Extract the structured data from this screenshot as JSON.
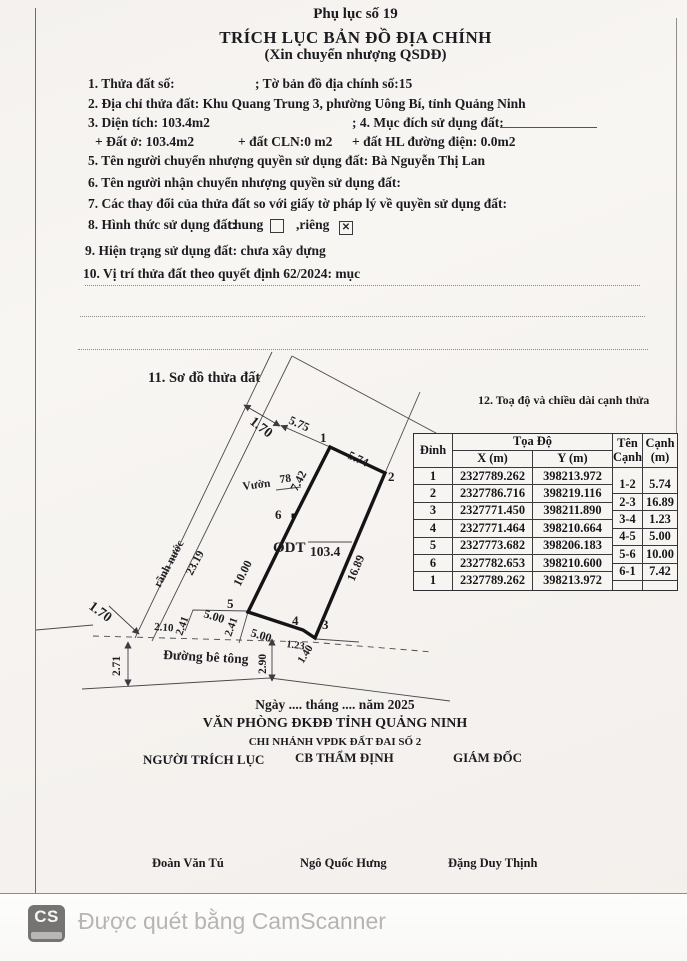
{
  "header": {
    "appendix": "Phụ lục số 19",
    "title": "TRÍCH LỤC BẢN ĐỒ ĐỊA CHÍNH",
    "subtitle": "(Xin chuyển nhượng QSDĐ)"
  },
  "fields": {
    "item1_label": "1. Thửa đất số:",
    "item1_value": "; Tờ bản đồ địa chính số:15",
    "item2": "2. Địa chỉ thửa đất: Khu Quang Trung 3, phường Uông Bí, tỉnh Quảng Ninh",
    "item3": "3. Diện tích: 103.4m2",
    "item4": "; 4. Mục đích sử dụng đất:",
    "item3_sub_a": "+ Đất ở: 103.4m2",
    "item3_sub_b": "+ đất CLN:0 m2",
    "item3_sub_c": "+ đất HL đường điện: 0.0m2",
    "item5": "5. Tên người chuyển nhượng quyền sử dụng đất: Bà Nguyễn Thị Lan",
    "item6": "6. Tên người nhận chuyển nhượng quyền sử dụng đất:",
    "item7": "7. Các thay đổi của thửa đất so với giấy tờ pháp lý về quyền sử dụng đất:",
    "item8_label": "8. Hình thức sử dụng đất:",
    "item8_chung": "chung",
    "item8_rieng": ",riêng",
    "item8_rieng_mark": "✕",
    "item9": "9. Hiện trạng sử dụng đất: chưa xây dựng",
    "item10": "10. Vị trí thửa đất theo quyết định 62/2024: mục"
  },
  "diagram": {
    "section_label": "11. Sơ đồ thửa đất",
    "area_label": "103.4",
    "land_use_code": "ODT",
    "labels": [
      {
        "t": "1.70",
        "x": 249,
        "y": 423,
        "r": 38,
        "s": 14
      },
      {
        "t": "5.75",
        "x": 288,
        "y": 423,
        "r": 24,
        "s": 12
      },
      {
        "t": "1",
        "x": 320,
        "y": 442,
        "r": 0,
        "s": 13
      },
      {
        "t": "5.74",
        "x": 347,
        "y": 458,
        "r": 25,
        "s": 12
      },
      {
        "t": "2",
        "x": 388,
        "y": 481,
        "r": 0,
        "s": 13
      },
      {
        "t": "Vườn",
        "x": 243,
        "y": 490,
        "r": -7,
        "s": 11.5
      },
      {
        "t": "78",
        "x": 280,
        "y": 483,
        "r": -7,
        "s": 11.5
      },
      {
        "t": "7.42",
        "x": 297,
        "y": 492,
        "r": -62,
        "s": 12
      },
      {
        "t": "6",
        "x": 275,
        "y": 519,
        "r": 0,
        "s": 13
      },
      {
        "t": "rãnh nước",
        "x": 160,
        "y": 588,
        "r": -62,
        "s": 11.5
      },
      {
        "t": "23.19",
        "x": 192,
        "y": 576,
        "r": -62,
        "s": 11.5
      },
      {
        "t": "ODT",
        "x": 273,
        "y": 552,
        "r": 0,
        "s": 15,
        "b": 1
      },
      {
        "t": "103.4",
        "x": 310,
        "y": 556,
        "r": 0,
        "s": 13.5
      },
      {
        "t": "16.89",
        "x": 354,
        "y": 582,
        "r": -67,
        "s": 12
      },
      {
        "t": "10.00",
        "x": 240,
        "y": 587,
        "r": -63,
        "s": 12
      },
      {
        "t": "5",
        "x": 227,
        "y": 608,
        "r": 0,
        "s": 13
      },
      {
        "t": "2.41",
        "x": 231,
        "y": 637,
        "r": -70,
        "s": 11
      },
      {
        "t": "5.00",
        "x": 250,
        "y": 636,
        "r": 17,
        "s": 12
      },
      {
        "t": "4",
        "x": 292,
        "y": 625,
        "r": 0,
        "s": 13
      },
      {
        "t": "3",
        "x": 322,
        "y": 629,
        "r": 0,
        "s": 13
      },
      {
        "t": "1.23",
        "x": 286,
        "y": 647,
        "r": 8,
        "s": 10.5
      },
      {
        "t": "1.40",
        "x": 303,
        "y": 664,
        "r": -58,
        "s": 11
      },
      {
        "t": "2.41",
        "x": 182,
        "y": 636,
        "r": -70,
        "s": 11
      },
      {
        "t": "5.00",
        "x": 203,
        "y": 617,
        "r": 17,
        "s": 12
      },
      {
        "t": "2.10",
        "x": 154,
        "y": 630,
        "r": 4,
        "s": 11
      },
      {
        "t": "1.70",
        "x": 88,
        "y": 608,
        "r": 36,
        "s": 14
      },
      {
        "t": "2.71",
        "x": 120,
        "y": 676,
        "r": -90,
        "s": 11.5
      },
      {
        "t": "Đường bê tông",
        "x": 163,
        "y": 659,
        "r": 3,
        "s": 13.5,
        "b": 1
      },
      {
        "t": "2.90",
        "x": 266,
        "y": 674,
        "r": -90,
        "s": 11.5
      }
    ]
  },
  "coord_table": {
    "section_label": "12. Toạ độ và chiều dài cạnh thửa",
    "headers": {
      "vertex": "Đỉnh",
      "coords": "Tọa Độ",
      "x": "X (m)",
      "y": "Y (m)",
      "edge_name": [
        "Tên",
        "Cạnh"
      ],
      "edge_len": [
        "Cạnh",
        "(m)"
      ]
    },
    "vertices": [
      {
        "id": "1",
        "x": "2327789.262",
        "y": "398213.972"
      },
      {
        "id": "2",
        "x": "2327786.716",
        "y": "398219.116"
      },
      {
        "id": "3",
        "x": "2327771.450",
        "y": "398211.890"
      },
      {
        "id": "4",
        "x": "2327771.464",
        "y": "398210.664"
      },
      {
        "id": "5",
        "x": "2327773.682",
        "y": "398206.183"
      },
      {
        "id": "6",
        "x": "2327782.653",
        "y": "398210.600"
      },
      {
        "id": "1",
        "x": "2327789.262",
        "y": "398213.972"
      }
    ],
    "edges": [
      {
        "name": "1-2",
        "len": "5.74"
      },
      {
        "name": "2-3",
        "len": "16.89"
      },
      {
        "name": "3-4",
        "len": "1.23"
      },
      {
        "name": "4-5",
        "len": "5.00"
      },
      {
        "name": "5-6",
        "len": "10.00"
      },
      {
        "name": "6-1",
        "len": "7.42"
      }
    ]
  },
  "footer": {
    "date_line": "Ngày .... tháng .... năm 2025",
    "office": "VĂN PHÒNG ĐKĐĐ TỈNH QUẢNG NINH",
    "branch": "CHI NHÁNH VPDK ĐẤT ĐAI SỐ 2",
    "role_extractor": "NGƯỜI TRÍCH LỤC",
    "role_appraiser": "CB THẨM ĐỊNH",
    "role_director": "GIÁM ĐỐC",
    "name_extractor": "Đoàn Văn Tú",
    "name_appraiser": "Ngô Quốc Hưng",
    "name_director": "Đặng Duy Thịnh"
  },
  "scanner_bar": {
    "logo": "CS",
    "text": "Được quét bằng CamScanner"
  }
}
